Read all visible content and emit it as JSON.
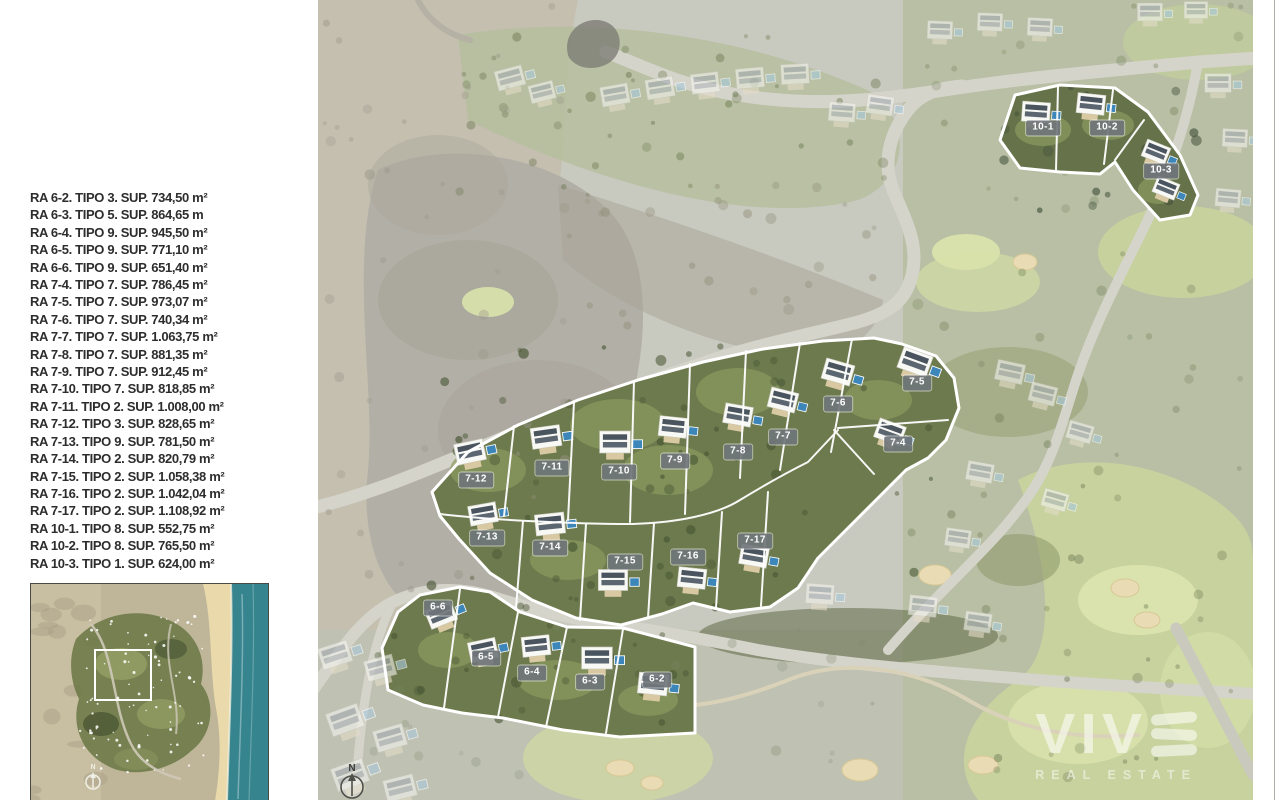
{
  "legend": {
    "items": [
      "RA 6-2. TIPO 3. SUP. 734,50 m²",
      "RA 6-3. TIPO 5. SUP. 864,65 m",
      "RA 6-4. TIPO 9. SUP. 945,50 m²",
      "RA 6-5. TIPO 9. SUP. 771,10 m²",
      "RA 6-6. TIPO 9. SUP. 651,40 m²",
      "RA 7-4. TIPO 7. SUP. 786,45 m²",
      "RA 7-5. TIPO 7. SUP. 973,07 m²",
      "RA 7-6. TIPO 7. SUP. 740,34 m²",
      "RA 7-7. TIPO 7. SUP. 1.063,75 m²",
      "RA 7-8. TIPO 7. SUP. 881,35 m²",
      "RA 7-9. TIPO 7. SUP. 912,45 m²",
      "RA 7-10. TIPO 7. SUP. 818,85 m²",
      "RA 7-11. TIPO 2. SUP. 1.008,00 m²",
      "RA 7-12. TIPO 3. SUP. 828,65 m²",
      "RA 7-13. TIPO 9. SUP. 781,50 m²",
      "RA 7-14. TIPO 2. SUP. 820,79 m²",
      "RA 7-15. TIPO 2. SUP. 1.058,38 m²",
      "RA 7-16. TIPO 2. SUP. 1.042,04 m²",
      "RA 7-17. TIPO 2. SUP. 1.108,92 m²",
      "RA 10-1. TIPO 8. SUP. 552,75 m²",
      "RA 10-2. TIPO 8. SUP. 765,50 m²",
      "RA 10-3. TIPO 1. SUP. 624,00 m²"
    ]
  },
  "map": {
    "compass_label": "N",
    "label_chip_color": "#707579",
    "plot_outline_color": "#ffffff",
    "plot_labels": [
      {
        "label": "10-1",
        "x": 725,
        "y": 128
      },
      {
        "label": "10-2",
        "x": 789,
        "y": 128
      },
      {
        "label": "10-3",
        "x": 843,
        "y": 171
      },
      {
        "label": "7-5",
        "x": 599,
        "y": 383
      },
      {
        "label": "7-6",
        "x": 520,
        "y": 404
      },
      {
        "label": "7-7",
        "x": 465,
        "y": 437
      },
      {
        "label": "7-4",
        "x": 580,
        "y": 444
      },
      {
        "label": "7-8",
        "x": 420,
        "y": 452
      },
      {
        "label": "7-9",
        "x": 357,
        "y": 461
      },
      {
        "label": "7-10",
        "x": 301,
        "y": 472
      },
      {
        "label": "7-11",
        "x": 234,
        "y": 468
      },
      {
        "label": "7-12",
        "x": 158,
        "y": 480
      },
      {
        "label": "7-13",
        "x": 169,
        "y": 538
      },
      {
        "label": "7-14",
        "x": 232,
        "y": 548
      },
      {
        "label": "7-15",
        "x": 307,
        "y": 562
      },
      {
        "label": "7-16",
        "x": 370,
        "y": 557
      },
      {
        "label": "7-17",
        "x": 437,
        "y": 541
      },
      {
        "label": "6-6",
        "x": 120,
        "y": 608
      },
      {
        "label": "6-5",
        "x": 168,
        "y": 658
      },
      {
        "label": "6-4",
        "x": 214,
        "y": 673
      },
      {
        "label": "6-3",
        "x": 272,
        "y": 682
      },
      {
        "label": "6-2",
        "x": 339,
        "y": 680
      }
    ]
  },
  "inset": {
    "compass_label": "N"
  },
  "watermark": {
    "brand": "VIVE",
    "tagline": "REAL ESTATE"
  }
}
